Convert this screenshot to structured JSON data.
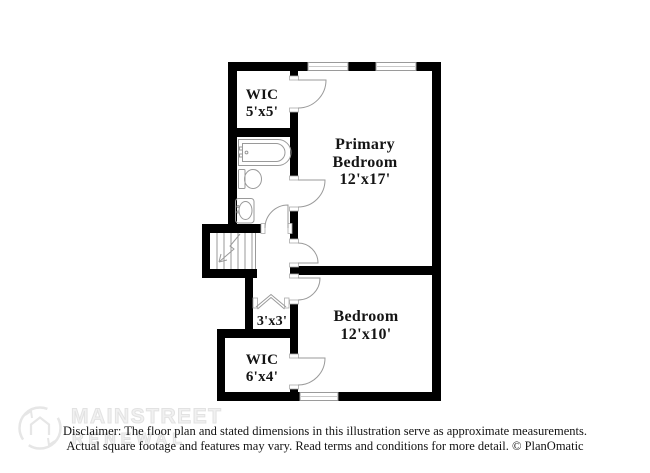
{
  "image": {
    "width": 650,
    "height": 473,
    "background": "#ffffff"
  },
  "floor_plan": {
    "rooms": [
      {
        "name": "WIC",
        "dims": "5'x5'"
      },
      {
        "name": "Primary Bedroom",
        "dims": "12'x17'"
      },
      {
        "name": "Bedroom",
        "dims": "12'x10'"
      },
      {
        "name": "",
        "dims": "3'x3'"
      },
      {
        "name": "WIC",
        "dims": "6'x4'"
      }
    ],
    "fixtures": [
      "bathtub",
      "toilet",
      "sink",
      "staircase"
    ],
    "features": {
      "windows": 3,
      "hinged_doors": 6,
      "bifold_doors": 1
    }
  },
  "watermark": {
    "brand_top": "MAINSTREET",
    "brand_bottom": "RENEWAL",
    "logo": "house-in-circle"
  },
  "disclaimer": {
    "line1": "Disclaimer: The floor plan and stated dimensions in this illustration serve as approximate measurements.",
    "line2": "Actual square footage and features may vary. Read terms and conditions for more detail. © PlanOmatic"
  },
  "colors": {
    "wall": "#000000",
    "thin_line": "#9a9a9a",
    "label_text": "#141414",
    "watermark": "#e8e8e8",
    "background": "#ffffff"
  }
}
